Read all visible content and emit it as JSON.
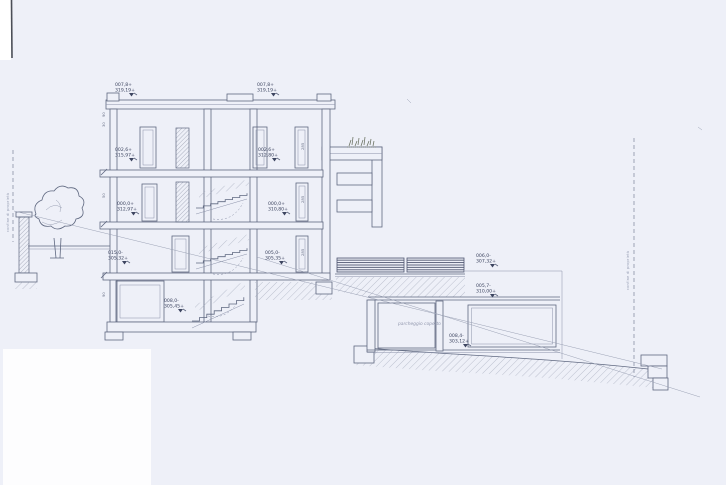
{
  "page": {
    "background": "#eef0f8",
    "paper_patch": "#fdfdfe",
    "ink": "#5f6880",
    "ink_dark": "#3d4560"
  },
  "drawing": {
    "boundary_left_text": "confine di proprietà",
    "boundary_right_text": "confine di proprietà",
    "garage_room_text": "parcheggio coperto",
    "elevation_labels": [
      {
        "l1": "007,8+",
        "l2": "319,19+"
      },
      {
        "l1": "007,8+",
        "l2": "319,19+"
      },
      {
        "l1": "002,6+",
        "l2": "315,97+"
      },
      {
        "l1": "002,6+",
        "l2": "312,80+"
      },
      {
        "l1": "000,0+",
        "l2": "312,97+"
      },
      {
        "l1": "000,0+",
        "l2": "310,80+"
      },
      {
        "l1": "015,0-",
        "l2": "305,32+"
      },
      {
        "l1": "005,0-",
        "l2": "305,35+"
      },
      {
        "l1": "008,0-",
        "l2": "305,45+"
      },
      {
        "l1": "006,0-",
        "l2": "307,32+"
      },
      {
        "l1": "005,7-",
        "l2": "310,00+"
      },
      {
        "l1": "008,4-",
        "l2": "303,12+"
      }
    ],
    "wall_dims": [
      "285",
      "285",
      "285",
      "90",
      "30",
      "50",
      "90"
    ]
  }
}
